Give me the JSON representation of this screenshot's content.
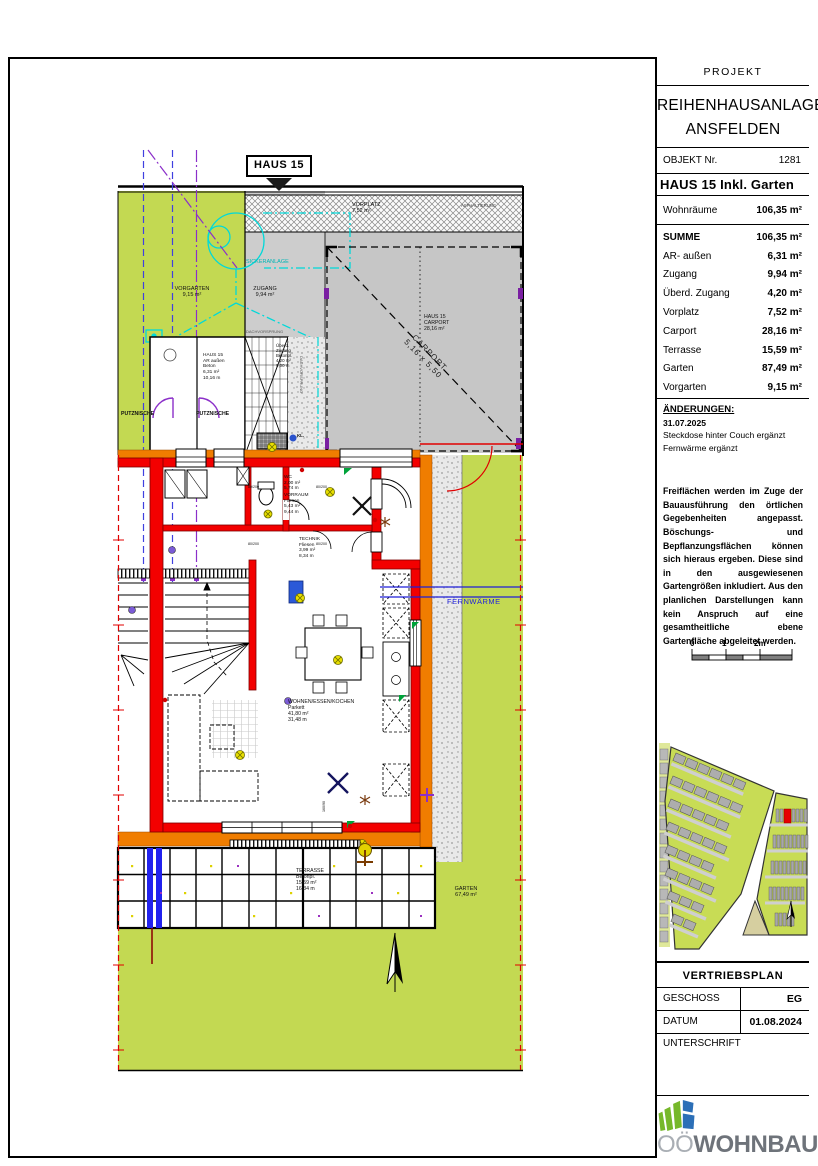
{
  "plan": {
    "badge": "HAUS 15",
    "labels": {
      "vorgarten": "VORGARTEN\n9,15 m²",
      "zugang": "ZUGANG\n9,94 m²",
      "sickeranlage": "SICKERANLAGE",
      "vorplatz": "VORPLATZ\n7,52 m²",
      "asphalt": "ASPHALTIERUNG",
      "carport": "HAUS 15\nCARPORT\n28,16 m²",
      "carport_diag": "CARPORT\n5,16 x 5,50",
      "ar_aussen": "HAUS 15\nAR außen\nBeton\n6,31 m²\n10,16 m",
      "putznische_1": "PUTZNISCHE",
      "putznische_2": "PUTZNISCHE",
      "dachvorsprung_h": "DACHVORSPRUNG",
      "dachvorsprung_v": "DACHVORSPRUNG",
      "ueberd_zugang": "Überd.\nZugang\nBetonpl.\n4,20 m²\n9,00 m",
      "kl": "KL.",
      "wc": "WC\n2,00 m²\n5,74 m",
      "vorraum": "VORRAUM\nFliesen\n5,43 m²\n9,44 m",
      "technik": "TECHNIK\nFliesen\n3,99 m²\n8,34 m",
      "wohnen": "WOHNEN/ESSEN/KOCHEN\nParkett\n41,80 m²\n31,48 m",
      "terrasse": "TERRASSE\nBetonpl.\n15,59 m²\n16,34 m",
      "garten": "GARTEN\n67,49 m²",
      "fernwaerme": "FERNWÄRME",
      "door_label": "80/200",
      "window_label": "160/90"
    }
  },
  "title_block": {
    "projekt_label": "PROJEKT",
    "project_name_line1": "REIHENHAUSANLAGE",
    "project_name_line2": "ANSFELDEN",
    "objekt_label": "OBJEKT Nr.",
    "objekt_nr": "1281",
    "object_title": "HAUS 15 Inkl. Garten",
    "wohnraeume_label": "Wohnräume",
    "wohnraeume_value": "106,35 m²",
    "summe_label": "SUMME",
    "summe_value": "106,35 m²",
    "areas": [
      {
        "label": "AR- außen",
        "value": "6,31 m²"
      },
      {
        "label": "Zugang",
        "value": "9,94 m²"
      },
      {
        "label": "Überd. Zugang",
        "value": "4,20 m²"
      },
      {
        "label": "Vorplatz",
        "value": "7,52 m²"
      },
      {
        "label": "Carport",
        "value": "28,16 m²"
      },
      {
        "label": "Terrasse",
        "value": "15,59 m²"
      },
      {
        "label": "Garten",
        "value": "87,49 m²"
      },
      {
        "label": "Vorgarten",
        "value": "9,15 m²"
      }
    ],
    "aenderungen_label": "ÄNDERUNGEN:",
    "aenderungen_date": "31.07.2025",
    "aenderungen_item1": "Steckdose hinter Couch ergänzt",
    "aenderungen_item2": "Fernwärme ergänzt",
    "disclaimer": "Freiflächen werden im Zuge der Bauausführung den örtlichen Gegebenheiten angepasst. Böschungs- und Bepflanzungsflächen können sich hieraus ergeben. Diese sind in den ausgewiesenen Gartengrößen inkludiert. Aus den planlichen Darstellungen kann kein Anspruch auf eine gesamtheitliche ebene Gartenfläche abgeleitet werden.",
    "scale": {
      "t0": "0",
      "t1": "1",
      "t2": "2m"
    },
    "plan_type": "VERTRIEBSPLAN",
    "geschoss_label": "GESCHOSS",
    "geschoss_value": "EG",
    "datum_label": "DATUM",
    "datum_value": "01.08.2024",
    "unterschrift_label": "UNTERSCHRIFT",
    "logo_prefix": "OÖ",
    "logo_name": "WOHNBAU"
  },
  "colors": {
    "green": "#c3d952",
    "gray_path": "#cdcdcd",
    "carport_gray": "#c6c6c6",
    "orange": "#f07d00",
    "wall_red": "#f30000",
    "cyan": "#00d9d9",
    "blue": "#2222ee",
    "purple": "#8b2fc9",
    "logo_green": "#76b82a",
    "logo_blue": "#2c6fb7"
  }
}
